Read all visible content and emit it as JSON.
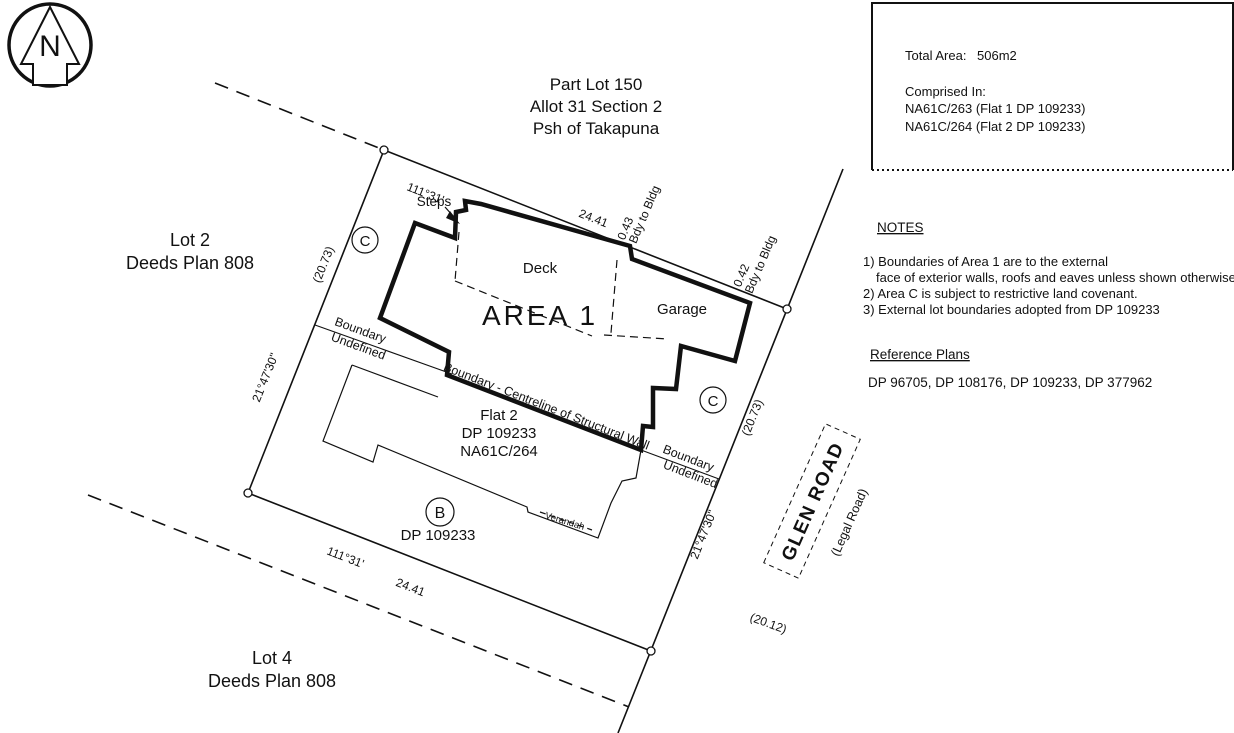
{
  "drawing": {
    "north_letter": "N",
    "header": {
      "line1": "Part Lot 150",
      "line2": "Allot 31 Section 2",
      "line3": "Psh of Takapuna"
    },
    "info_box": {
      "total_area_label": "Total Area:",
      "total_area_value": "506m2",
      "comprised_in": "Comprised In:",
      "title_1": "NA61C/263 (Flat 1 DP 109233)",
      "title_2": "NA61C/264 (Flat 2  DP 109233)"
    },
    "notes": {
      "heading": "NOTES",
      "note_1a": "1) Boundaries of Area 1 are to the external",
      "note_1b": "face of exterior walls, roofs and eaves unless shown otherwise.",
      "note_2": "2) Area C is subject to restrictive land covenant.",
      "note_3": "3) External lot boundaries adopted from DP 109233"
    },
    "reference_plans": {
      "heading": "Reference Plans",
      "plans": "DP 96705, DP 108176, DP 109233, DP 377962"
    },
    "parcels": {
      "lot2_line1": "Lot 2",
      "lot2_line2": "Deeds Plan 808",
      "lot4_line1": "Lot 4",
      "lot4_line2": "Deeds Plan 808",
      "area1": "AREA 1",
      "flat2_line1": "Flat 2",
      "flat2_line2": "DP 109233",
      "flat2_line3": "NA61C/264",
      "area_b": "B",
      "area_b_plan": "DP 109233",
      "area_c_left": "C",
      "area_c_right": "C"
    },
    "features": {
      "steps": "Steps",
      "deck": "Deck",
      "garage": "Garage",
      "verandah": "Verandah"
    },
    "dims": {
      "north_bearing": "111°31'",
      "north_distance": "24.41",
      "south_bearing": "111°31'",
      "south_distance": "24.41",
      "west_distance": "(20.73)",
      "west_bearing": "21°47'30\"",
      "east_distance": "(20.73)",
      "east_bearing": "21°47'30\"",
      "road_distance": "(20.12)",
      "bdy1_value": "0.43",
      "bdy1_label": "Bdy to Bldg",
      "bdy2_value": "0.42",
      "bdy2_label": "Bdy to Bldg"
    },
    "boundary_labels": {
      "centreline": "Boundary - Centreline of Structural Wall",
      "undef_left_1": "Boundary",
      "undef_left_2": "Undefined",
      "undef_right_1": "Boundary",
      "undef_right_2": "Undefined"
    },
    "road": {
      "name": "GLEN ROAD",
      "legal": "(Legal Road)"
    },
    "colors": {
      "ink": "#111111",
      "paper": "#ffffff"
    }
  }
}
